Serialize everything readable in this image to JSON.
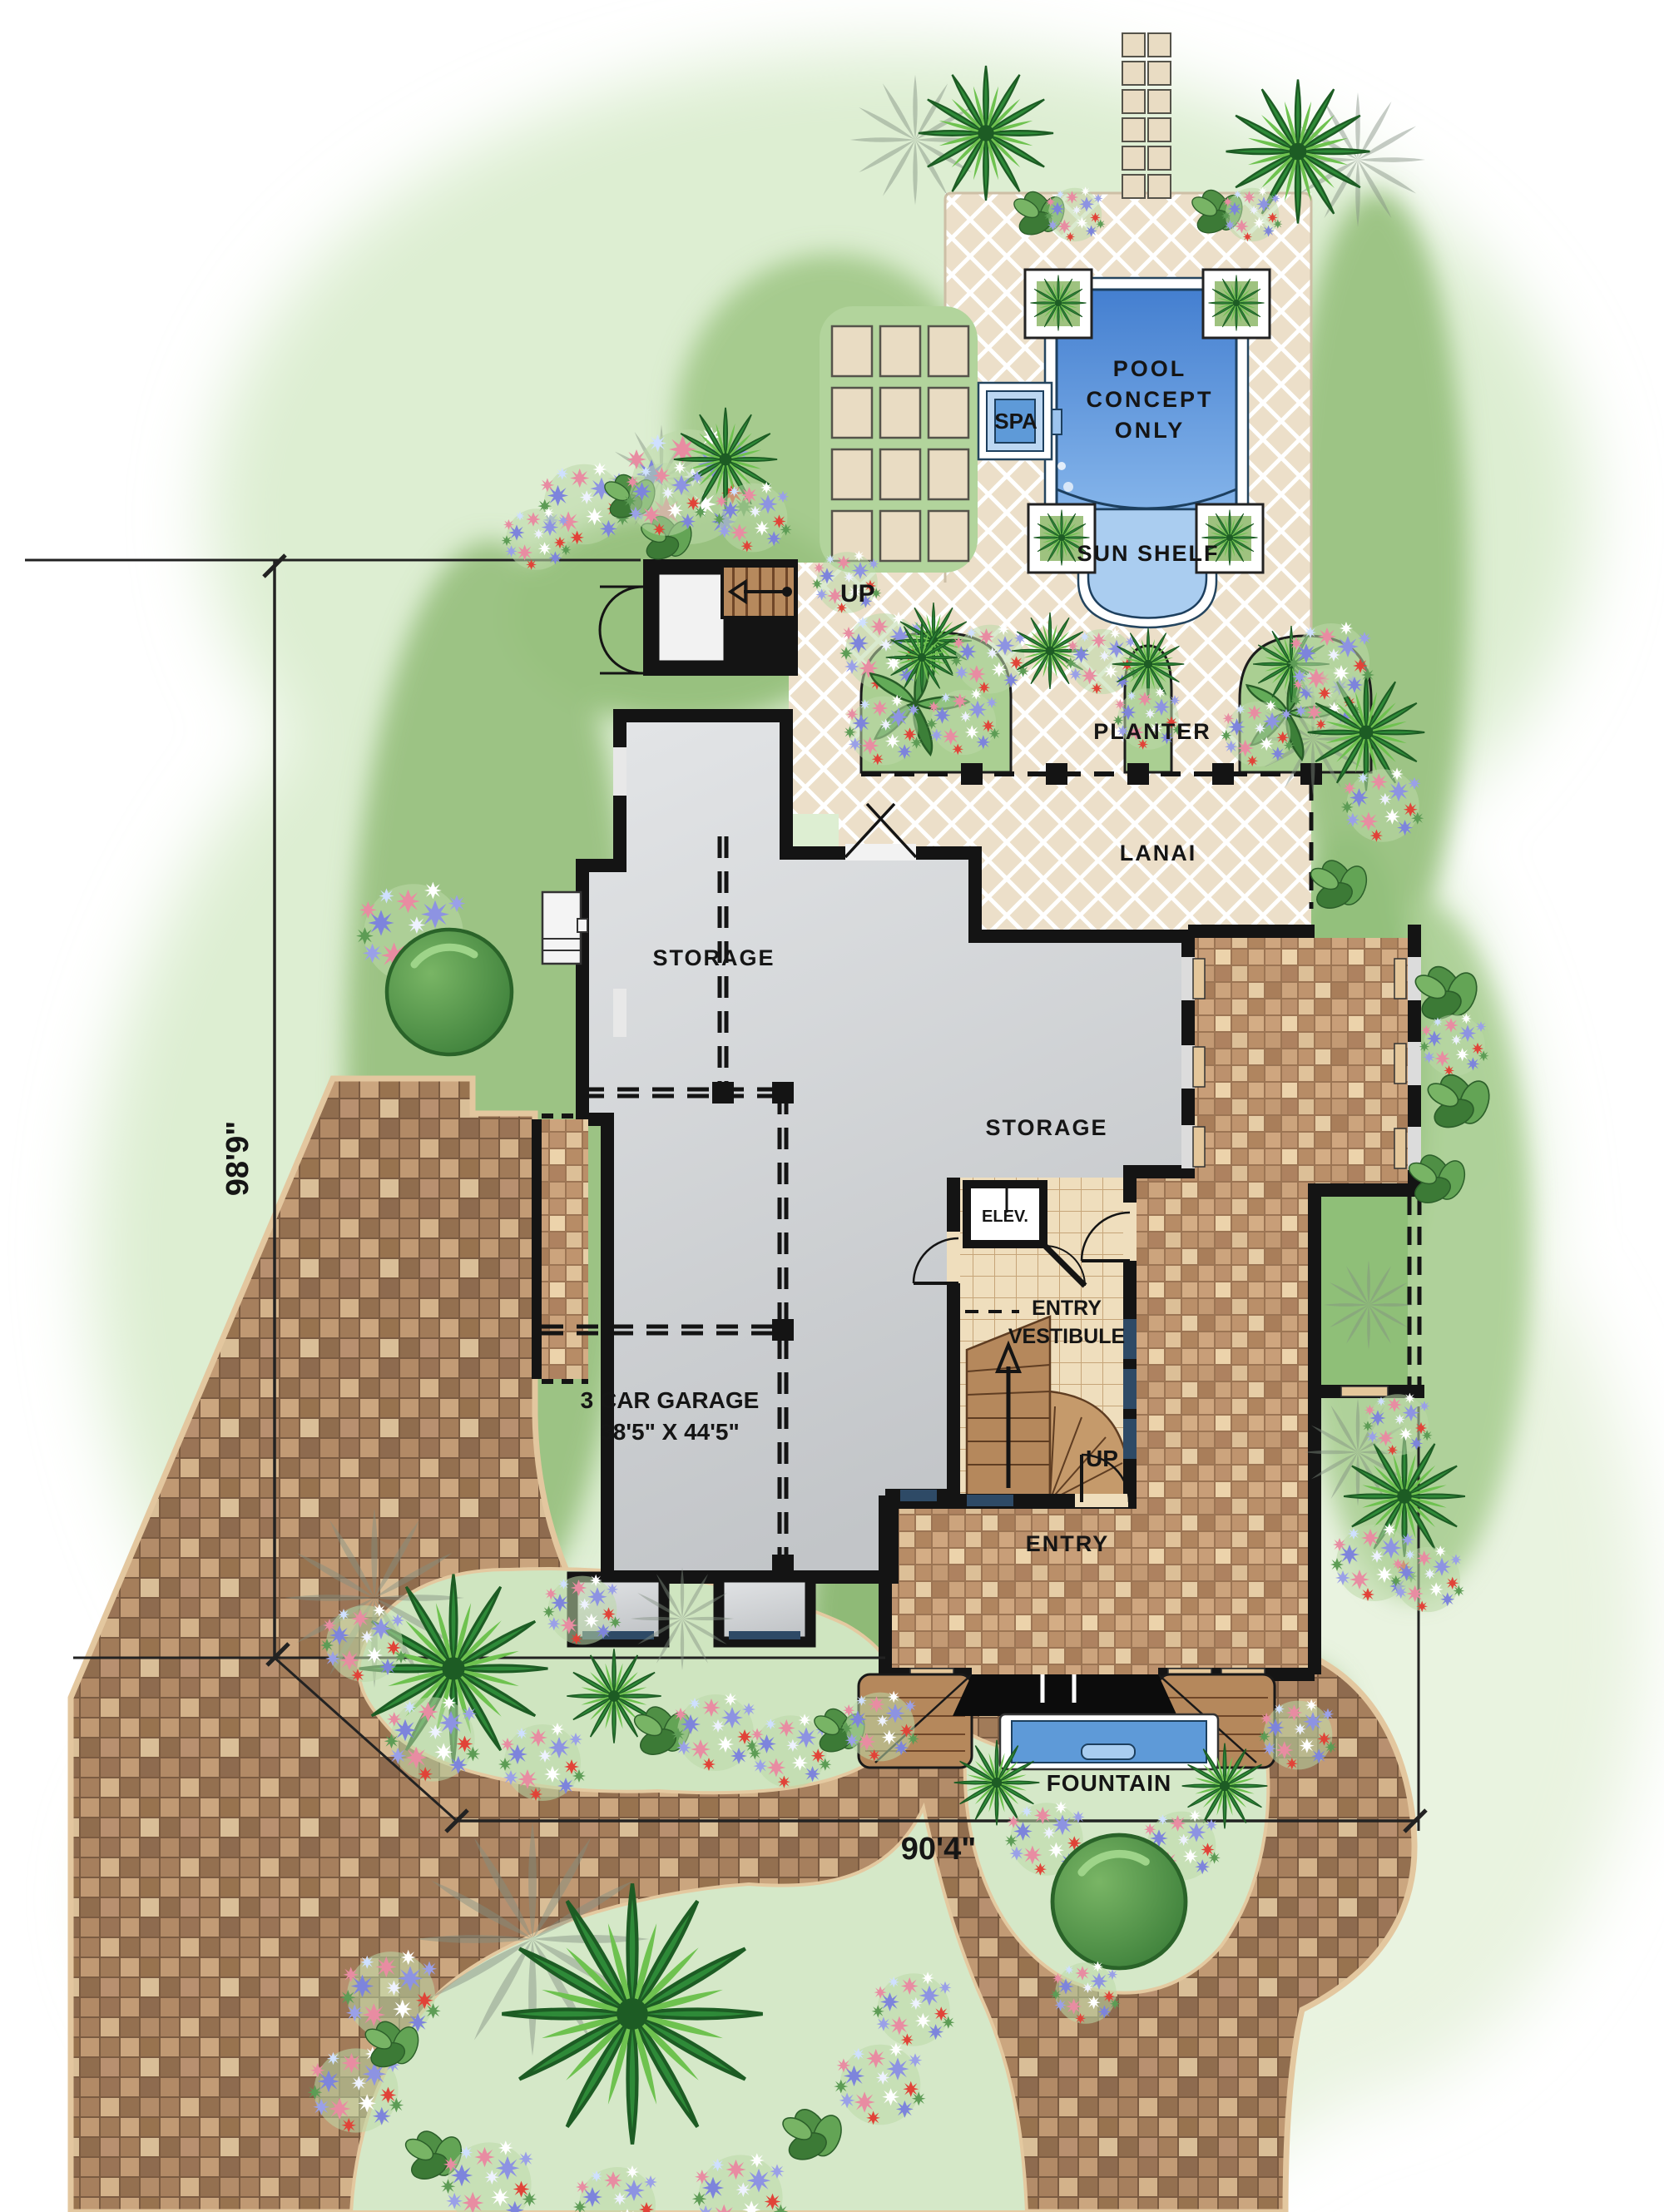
{
  "pool_area": {
    "pool_line1": "POOL",
    "pool_line2": "CONCEPT",
    "pool_line3": "ONLY",
    "spa": "SPA",
    "sun_shelf": "SUN SHELF",
    "stairs_up": "UP"
  },
  "lanai_area": {
    "planter": "PLANTER",
    "lanai": "LANAI"
  },
  "house": {
    "storage_upper": "STORAGE",
    "storage_main": "STORAGE",
    "garage_name": "3 CAR GARAGE",
    "garage_size": "38'5\" X 44'5\"",
    "elevator": "ELEV.",
    "vestibule_line1": "ENTRY",
    "vestibule_line2": "VESTIBULE",
    "vestibule_stairs_up": "UP",
    "entry": "ENTRY"
  },
  "site": {
    "fountain": "FOUNTAIN",
    "dimension_west": "98'9\"",
    "dimension_south": "90'4\""
  },
  "colors": {
    "lawn_light": "#ddeed2",
    "lawn_dark": "#93c07c",
    "deck_tan": "#ecdfc9",
    "drive_brick": "#a5805e",
    "entry_brick": "#c59c79",
    "pool_blue": "#4a86d4",
    "shelf_blue": "#a9cdf0",
    "wall_black": "#141414",
    "interior_gray": "#d3d6d8",
    "wood_brown": "#b5885c",
    "tile_tan": "#efdebd"
  }
}
